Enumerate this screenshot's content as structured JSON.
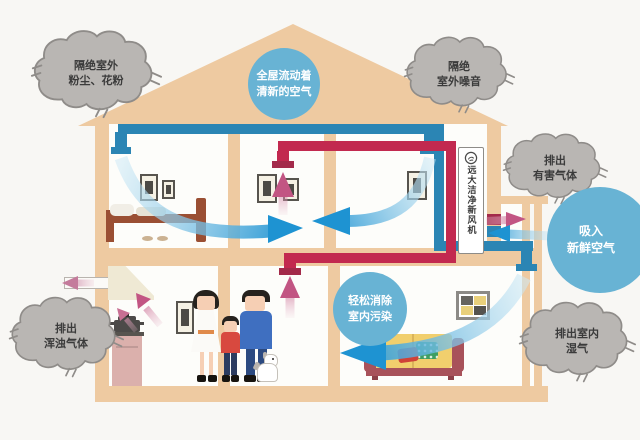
{
  "colors": {
    "bg": "#f8f7f4",
    "wall": "#eecaa1",
    "room": "#fdfdfa",
    "pipe-fresh": "#2b85b4",
    "pipe-exhaust": "#c2294f",
    "pipe-exhaust-dark": "#a32a4a",
    "cloud-fill": "#b9b6b3",
    "cloud-line": "#8f8c89",
    "cloud-text": "#3b3b3b",
    "bubble": "#68b3d4",
    "arrow-fresh": "#1e93d2",
    "arrow-fresh-light": "#cfeaf6",
    "arrow-exhaust": "#c25583"
  },
  "clouds": {
    "dust": {
      "lines": [
        "隔绝室外",
        "粉尘、花粉"
      ]
    },
    "noise": {
      "lines": [
        "隔绝",
        "室外噪音"
      ]
    },
    "harmful": {
      "lines": [
        "排出",
        "有害气体"
      ]
    },
    "turbid": {
      "lines": [
        "排出",
        "浑浊气体"
      ]
    },
    "moisture": {
      "lines": [
        "排出室内",
        "湿气"
      ]
    }
  },
  "bubbles": {
    "fresh_flow": {
      "lines": [
        "全屋流动着",
        "清新的空气"
      ]
    },
    "intake": {
      "lines": [
        "吸入",
        "新鲜空气"
      ]
    },
    "pollution": {
      "lines": [
        "轻松消除",
        "室内污染"
      ]
    }
  },
  "machine": {
    "label": "远大洁净新风机"
  }
}
